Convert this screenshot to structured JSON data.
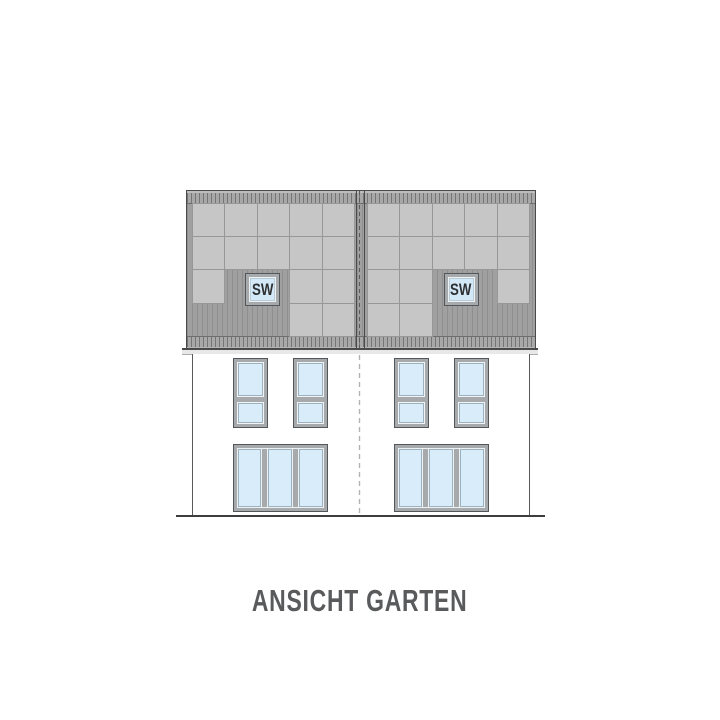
{
  "page": {
    "background": "#ffffff"
  },
  "title": {
    "text": "ANSICHT GARTEN"
  },
  "skylight": {
    "label": "SW"
  },
  "drawing": {
    "type": "architectural-elevation",
    "houses": 2,
    "solar_panels": {
      "cols": 5,
      "rows": 4,
      "left_grid": [
        "11111",
        "11111",
        "10011",
        "00011"
      ],
      "right_grid": [
        "11111",
        "11111",
        "11001",
        "11000"
      ]
    },
    "windows_per_house": {
      "upper_double": 2,
      "lower_triple": 1
    },
    "roof_windows_per_house": 1
  },
  "colors": {
    "page-bg": "#ffffff",
    "roof-field": "#a0a0a0",
    "roof-stripe": "#8f8f8f",
    "roof-outline": "#4a4a4a",
    "band-bg": "#a8a8a8",
    "band-tick": "#757575",
    "panel": "#c6c6c6",
    "panel-line": "#979797",
    "frame": "#a6aaad",
    "frame-outline": "#54575a",
    "glass": "#d8ecf9",
    "glass-edge": "#9db2c0",
    "skylight-glass": "#d3e9f7",
    "dash-wall": "#b3b3b3",
    "dash-roof": "#5a5a5a",
    "ground": "#3d3d3d",
    "text": "#595a5c",
    "label": "#2e3032"
  }
}
